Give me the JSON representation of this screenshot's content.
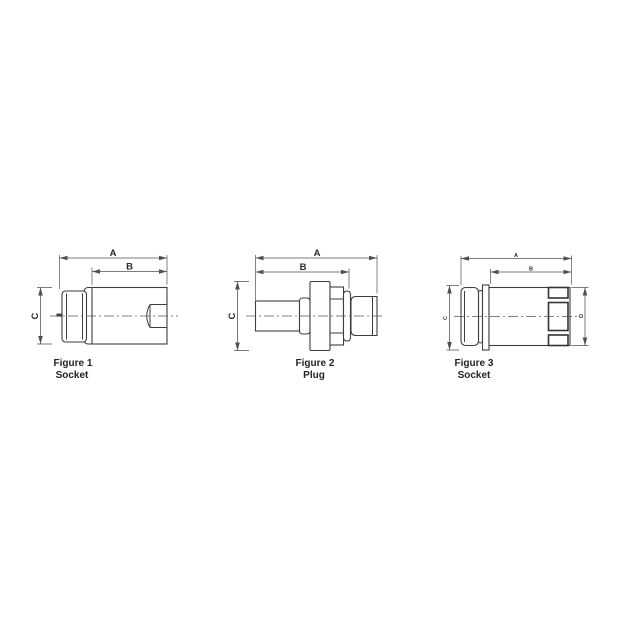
{
  "sheet": {
    "background": "#ffffff",
    "colors": {
      "line": "#3e3e3e",
      "dimension": "#505050",
      "text": "#232323"
    }
  },
  "figures": [
    {
      "caption_line1": "Figure 1",
      "caption_line2": "Socket",
      "dim_a": "A",
      "dim_b": "B",
      "dim_c": "C"
    },
    {
      "caption_line1": "Figure 2",
      "caption_line2": "Plug",
      "dim_a": "A",
      "dim_b": "B",
      "dim_c": "C"
    },
    {
      "caption_line1": "Figure 3",
      "caption_line2": "Socket",
      "dim_a": "A",
      "dim_b": "B",
      "dim_c": "C",
      "dim_d": "D"
    }
  ]
}
